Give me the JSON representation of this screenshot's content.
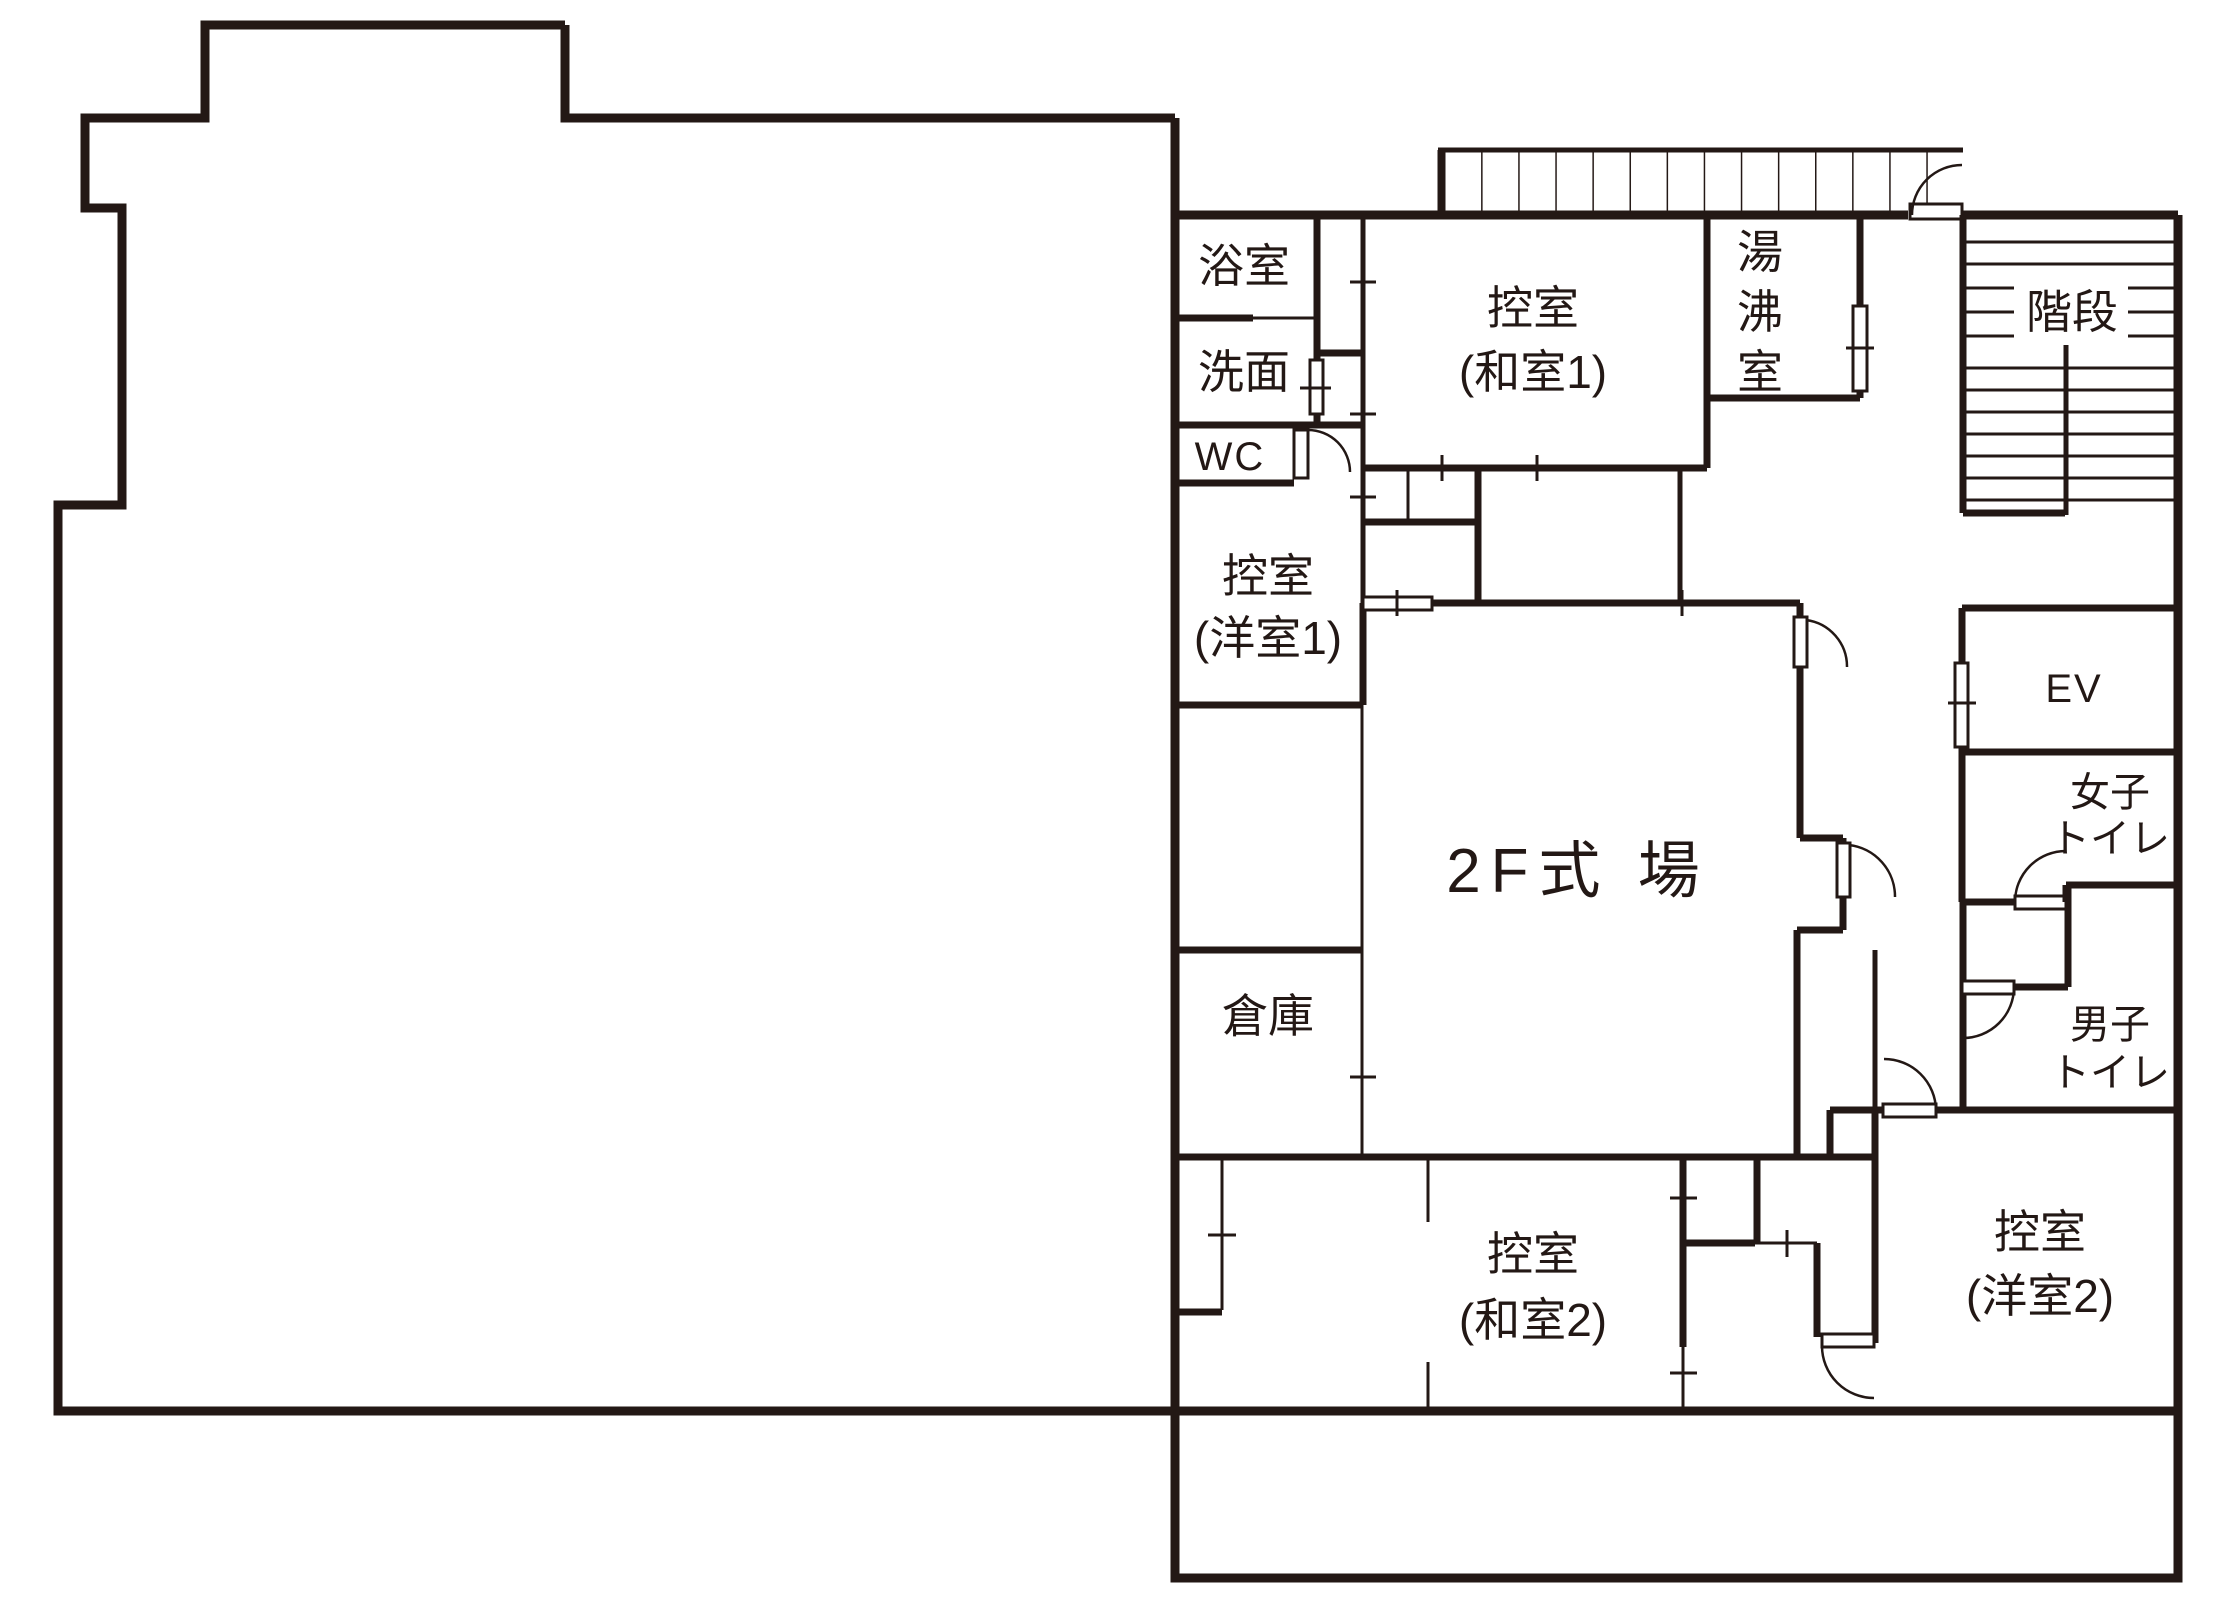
{
  "floor": "2F",
  "colors": {
    "wall": "#231815",
    "background": "#ffffff"
  },
  "rooms": {
    "bath": {
      "label": "浴室"
    },
    "washroom": {
      "label": "洗面"
    },
    "wc": {
      "label": "WC"
    },
    "waiting_western1": {
      "line1": "控室",
      "line2": "(洋室1)"
    },
    "waiting_japanese1": {
      "line1": "控室",
      "line2": "(和室1)"
    },
    "hot_water_room": {
      "label": "湯沸室",
      "char1": "湯",
      "char2": "沸",
      "char3": "室"
    },
    "stairs": {
      "label": "階段"
    },
    "elevator": {
      "label": "EV"
    },
    "womens_toilet": {
      "line1": "女子",
      "line2": "トイレ"
    },
    "mens_toilet": {
      "line1": "男子",
      "line2": "トイレ"
    },
    "ceremony_hall": {
      "label": "2F式 場"
    },
    "storage": {
      "label": "倉庫"
    },
    "waiting_japanese2": {
      "line1": "控室",
      "line2": "(和室2)"
    },
    "waiting_western2": {
      "line1": "控室",
      "line2": "(洋室2)"
    }
  }
}
